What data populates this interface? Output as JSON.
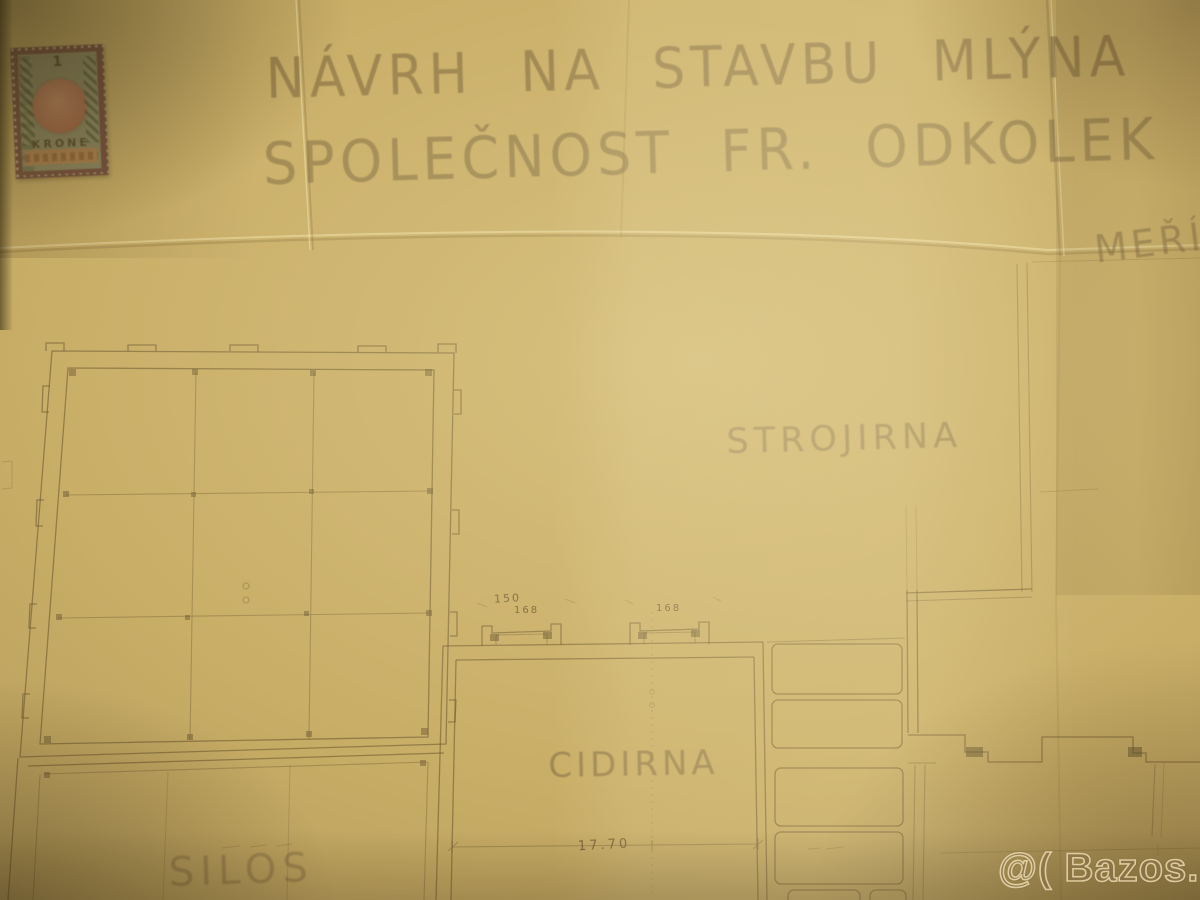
{
  "photo": {
    "description": "Photograph of a folded historic architectural floor plan (mill construction proposal) with a revenue stamp and classifieds watermark"
  },
  "title_block": {
    "line1": "NÁVRH NA STAVBU MLÝNA",
    "line2": "SPOLEČNOST FR. ODKOLEK V",
    "scale_label": "MEŘÍ"
  },
  "revenue_stamp": {
    "value": "1",
    "denomination": "KRONE"
  },
  "floor_plan": {
    "room_labels": [
      {
        "id": "strojirna",
        "label": "STROJIRNA"
      },
      {
        "id": "cidirna",
        "label": "CIDIRNA"
      },
      {
        "id": "silos",
        "label": "SILOS"
      }
    ],
    "dimensions": [
      {
        "id": "door-left-width",
        "text": "150"
      },
      {
        "id": "door-left-height",
        "text": "168"
      },
      {
        "id": "door-right-height",
        "text": "168"
      },
      {
        "id": "cidirna-width",
        "text": "17.70"
      }
    ]
  },
  "watermark": {
    "text": "@( Bazos.cz"
  },
  "colors": {
    "paper_mid": "#c9ae67",
    "paper_bright": "#e4d094",
    "paper_dark": "#8f7a44",
    "ink": "#6e5832",
    "stamp_red": "#bd7047",
    "stamp_green": "#8f8c5c",
    "stamp_orange": "#bd8342",
    "stamp_frame": "#7c4b38"
  }
}
